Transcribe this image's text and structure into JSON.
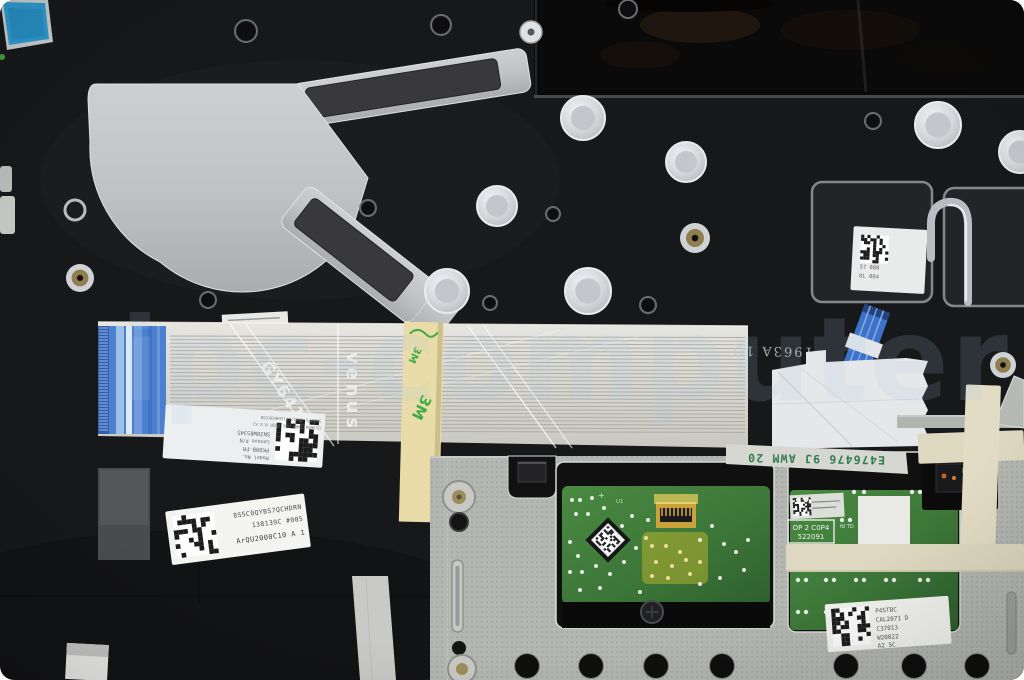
{
  "watermark": {
    "text": "ipc-computer",
    "color": "#a9cbe8"
  },
  "markings": {
    "cable_print_1": "GY641-2",
    "cable_print_2": "venus",
    "tape_logo": "3M",
    "ul_cable_marking": "E476476 9J AWM 20",
    "stamped_code": "1963A 1Q",
    "pcb_stamp_line1": "OP 2 C0P4",
    "pcb_stamp_line2": "522091",
    "pcb_stamp_side": "NI TD",
    "pcb_silkscreen_u1": "U1",
    "pcb_silkscreen_plus": "+"
  },
  "labels": {
    "cable_label": {
      "lines": [
        "Model No.",
        "PK09B-FR",
        "Lenovo P/N",
        "SN20W85345",
        "US0BRA1TARS JB1 TU1R N.V.KJ",
        "5W10PS T2017GP1GBHH1KS5B"
      ]
    },
    "palmrest_label": {
      "line1": "8SSC0QYBS7QCHDRN",
      "line2": "138139C #005",
      "line3": "ArQU2000C10  A 1"
    },
    "touchpad_label": {
      "lines": [
        "P4STBC",
        "CAL2071 D",
        "C37013",
        "W20022",
        "A2  5C"
      ]
    },
    "bracket_label": {
      "line1": "57 088",
      "line2": "0L 004"
    }
  },
  "colors": {
    "background": "#17181a",
    "glossy_black": "#0a0a0b",
    "bracket_silver": "#c3c5c7",
    "touchpad_bracket": "#b4b6b1",
    "cable_base": "#dcdbd4",
    "connector_blue": "#4b7fd0",
    "pcb_green": "#3f7d3c",
    "kapton_yellow": "#d8c42a",
    "adhesive_yellow": "#e9dca8",
    "tape_cream": "#ded8c0",
    "logo_green": "#3fae49",
    "ul_text_green": "#2f7d52",
    "blue_tape": "#2e9ace",
    "label_white": "#f2f2ef"
  }
}
